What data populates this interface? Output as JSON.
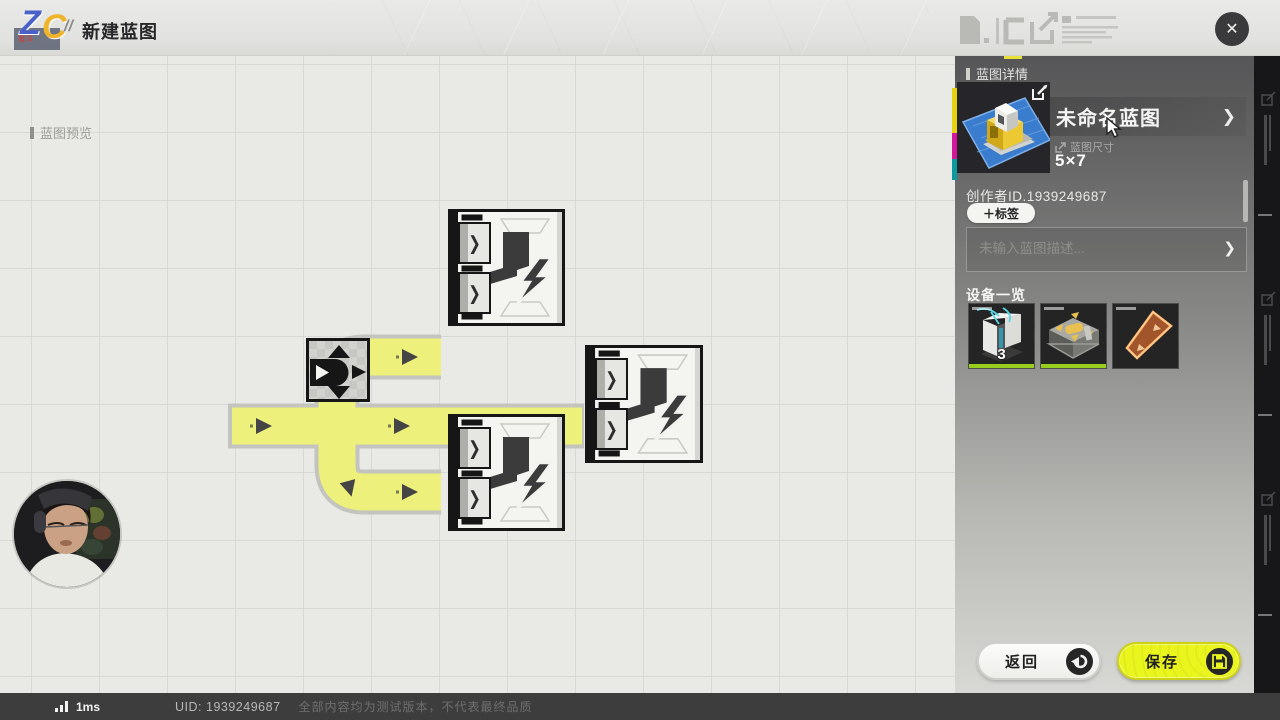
{
  "topbar": {
    "logo_z": "Z",
    "logo_c": "C",
    "logo_sub": "魔泽",
    "logo_slashes": "//",
    "title": "新建蓝图"
  },
  "canvas": {
    "preview_label": "蓝图预览"
  },
  "panel": {
    "header": "蓝图详情",
    "name": "未命名蓝图",
    "size_label": "蓝图尺寸",
    "size_value": "5×7",
    "creator": "创作者ID.1939249687",
    "tag_button": "＋标签",
    "description_placeholder": "未输入蓝图描述...",
    "equipment_header": "设备一览",
    "equipment": [
      {
        "name": "压印机器",
        "count": "3"
      },
      {
        "name": "分流器",
        "count": ""
      },
      {
        "name": "传送带",
        "count": ""
      }
    ]
  },
  "buttons": {
    "back": "返回",
    "save": "保存"
  },
  "statusbar": {
    "ping": "1ms",
    "uid": "UID: 1939249687",
    "disclaimer": "全部内容均为测试版本，不代表最终品质"
  },
  "icons": {
    "chevron_right": "❯",
    "close": "✕"
  },
  "colors": {
    "belt_yellow": "#edf07a",
    "accent_yellow": "#eaf51e",
    "equip_green": "#96cd1e"
  }
}
